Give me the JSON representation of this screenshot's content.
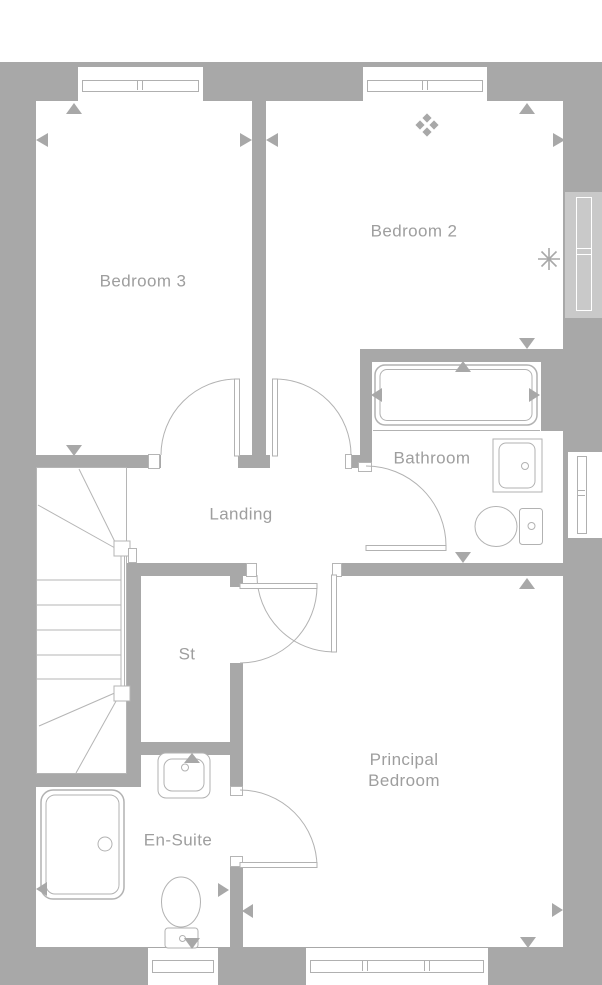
{
  "rooms": {
    "bedroom3": {
      "label": "Bedroom 3"
    },
    "bedroom2": {
      "label": "Bedroom 2"
    },
    "bathroom": {
      "label": "Bathroom"
    },
    "landing": {
      "label": "Landing"
    },
    "store": {
      "label": "St"
    },
    "ensuite": {
      "label": "En-Suite"
    },
    "principal": {
      "label": "Principal\nBedroom"
    }
  },
  "colors": {
    "wall": "#a8a8a8",
    "fixture_line": "#b2b2b2",
    "label_text": "#9e9e9e",
    "window_tint": "#c9c9c9",
    "background": "#ffffff"
  },
  "icons": [
    {
      "name": "diamond-cluster-icon"
    },
    {
      "name": "asterisk-icon"
    },
    {
      "name": "bathtub-icon"
    },
    {
      "name": "bathroom-basin-icon"
    },
    {
      "name": "bathroom-toilet-icon"
    },
    {
      "name": "ensuite-basin-icon"
    },
    {
      "name": "ensuite-toilet-icon"
    },
    {
      "name": "shower-tray-icon"
    },
    {
      "name": "staircase-icon"
    },
    {
      "name": "dimension-arrow-icon"
    }
  ]
}
